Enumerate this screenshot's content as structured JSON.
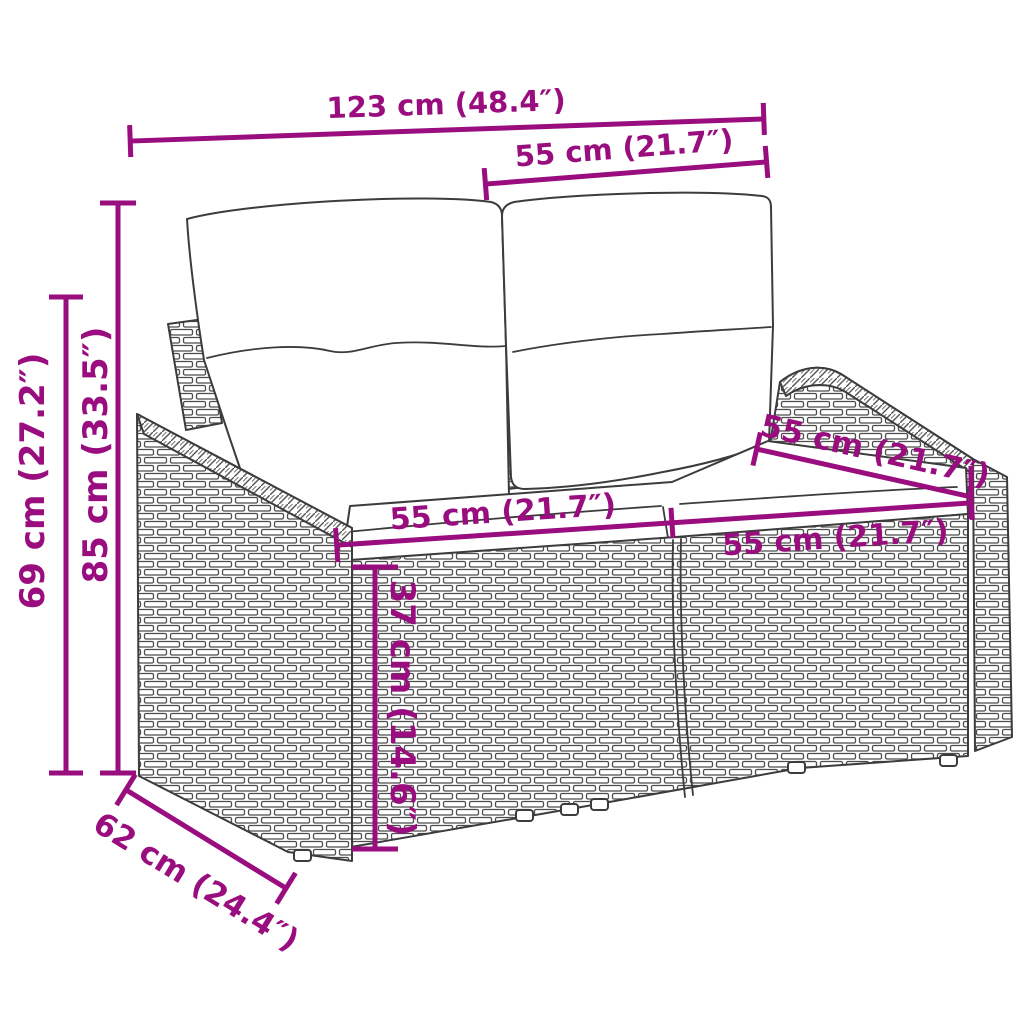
{
  "diagram": {
    "type": "product-dimension-diagram",
    "subject": "poly-rattan garden loveseat with two back cushions and two seat cushions",
    "style": {
      "accent_color": "#990d7f",
      "line_art_color": "#3c3c3c",
      "background_color": "#ffffff"
    },
    "dimensions": [
      {
        "id": "overall-width",
        "label": "123 cm (48.4″)",
        "cm": 123,
        "inches": 48.4,
        "orientation": "horizontal-top"
      },
      {
        "id": "right-seat-width-top",
        "label": "55 cm (21.7″)",
        "cm": 55,
        "inches": 21.7,
        "orientation": "horizontal-top"
      },
      {
        "id": "overall-height",
        "label": "85 cm (33.5″)",
        "cm": 85,
        "inches": 33.5,
        "orientation": "vertical-left"
      },
      {
        "id": "armrest-height",
        "label": "69 cm (27.2″)",
        "cm": 69,
        "inches": 27.2,
        "orientation": "vertical-left"
      },
      {
        "id": "left-seat-width",
        "label": "55 cm (21.7″)",
        "cm": 55,
        "inches": 21.7,
        "orientation": "along-seat-front-left"
      },
      {
        "id": "right-seat-width",
        "label": "55 cm (21.7″)",
        "cm": 55,
        "inches": 21.7,
        "orientation": "along-seat-front-right"
      },
      {
        "id": "seat-depth",
        "label": "55 cm (21.7″)",
        "cm": 55,
        "inches": 21.7,
        "orientation": "diagonal-right"
      },
      {
        "id": "seat-height",
        "label": "37 cm (14.6″)",
        "cm": 37,
        "inches": 14.6,
        "orientation": "vertical-middle"
      },
      {
        "id": "base-depth",
        "label": "62 cm (24.4″)",
        "cm": 62,
        "inches": 24.4,
        "orientation": "diagonal-bottom-left"
      }
    ]
  }
}
